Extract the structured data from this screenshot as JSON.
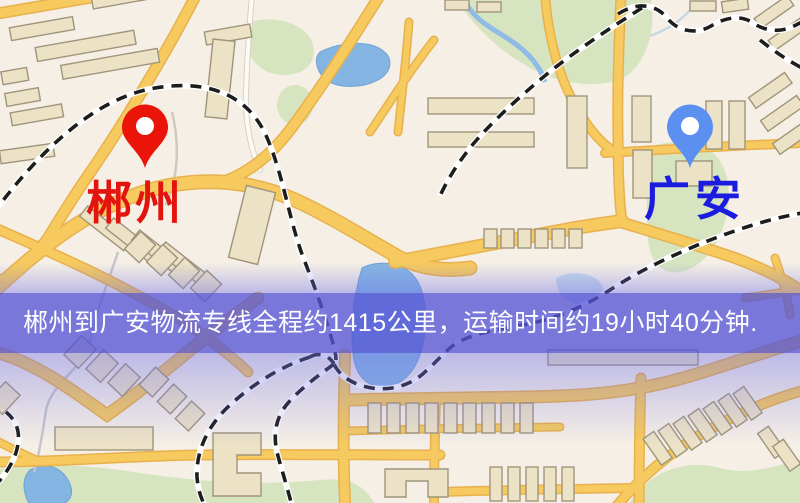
{
  "map": {
    "markers": [
      {
        "id": "origin",
        "label": "郴州",
        "pin_color": "#ea1508",
        "label_color": "#e3140e"
      },
      {
        "id": "destination",
        "label": "广安",
        "pin_color": "#5c90f0",
        "label_color": "#1c1ce0"
      }
    ],
    "banner": {
      "text": "郴州到广安物流专线全程约1415公里，运输时间约19小时40分钟.",
      "background_color": "#5655d6",
      "text_color": "#ffffff"
    },
    "palette": {
      "land": "#f5efe6",
      "road_major": "#f6ca5e",
      "road_casing": "#e8b14d",
      "building": "#ece2c6",
      "building_outline": "#a0957c",
      "park": "#d7e4c0",
      "water": "#84b5e2",
      "rail": "#1d1d1d",
      "overlay_blue": "#7070e8"
    }
  }
}
